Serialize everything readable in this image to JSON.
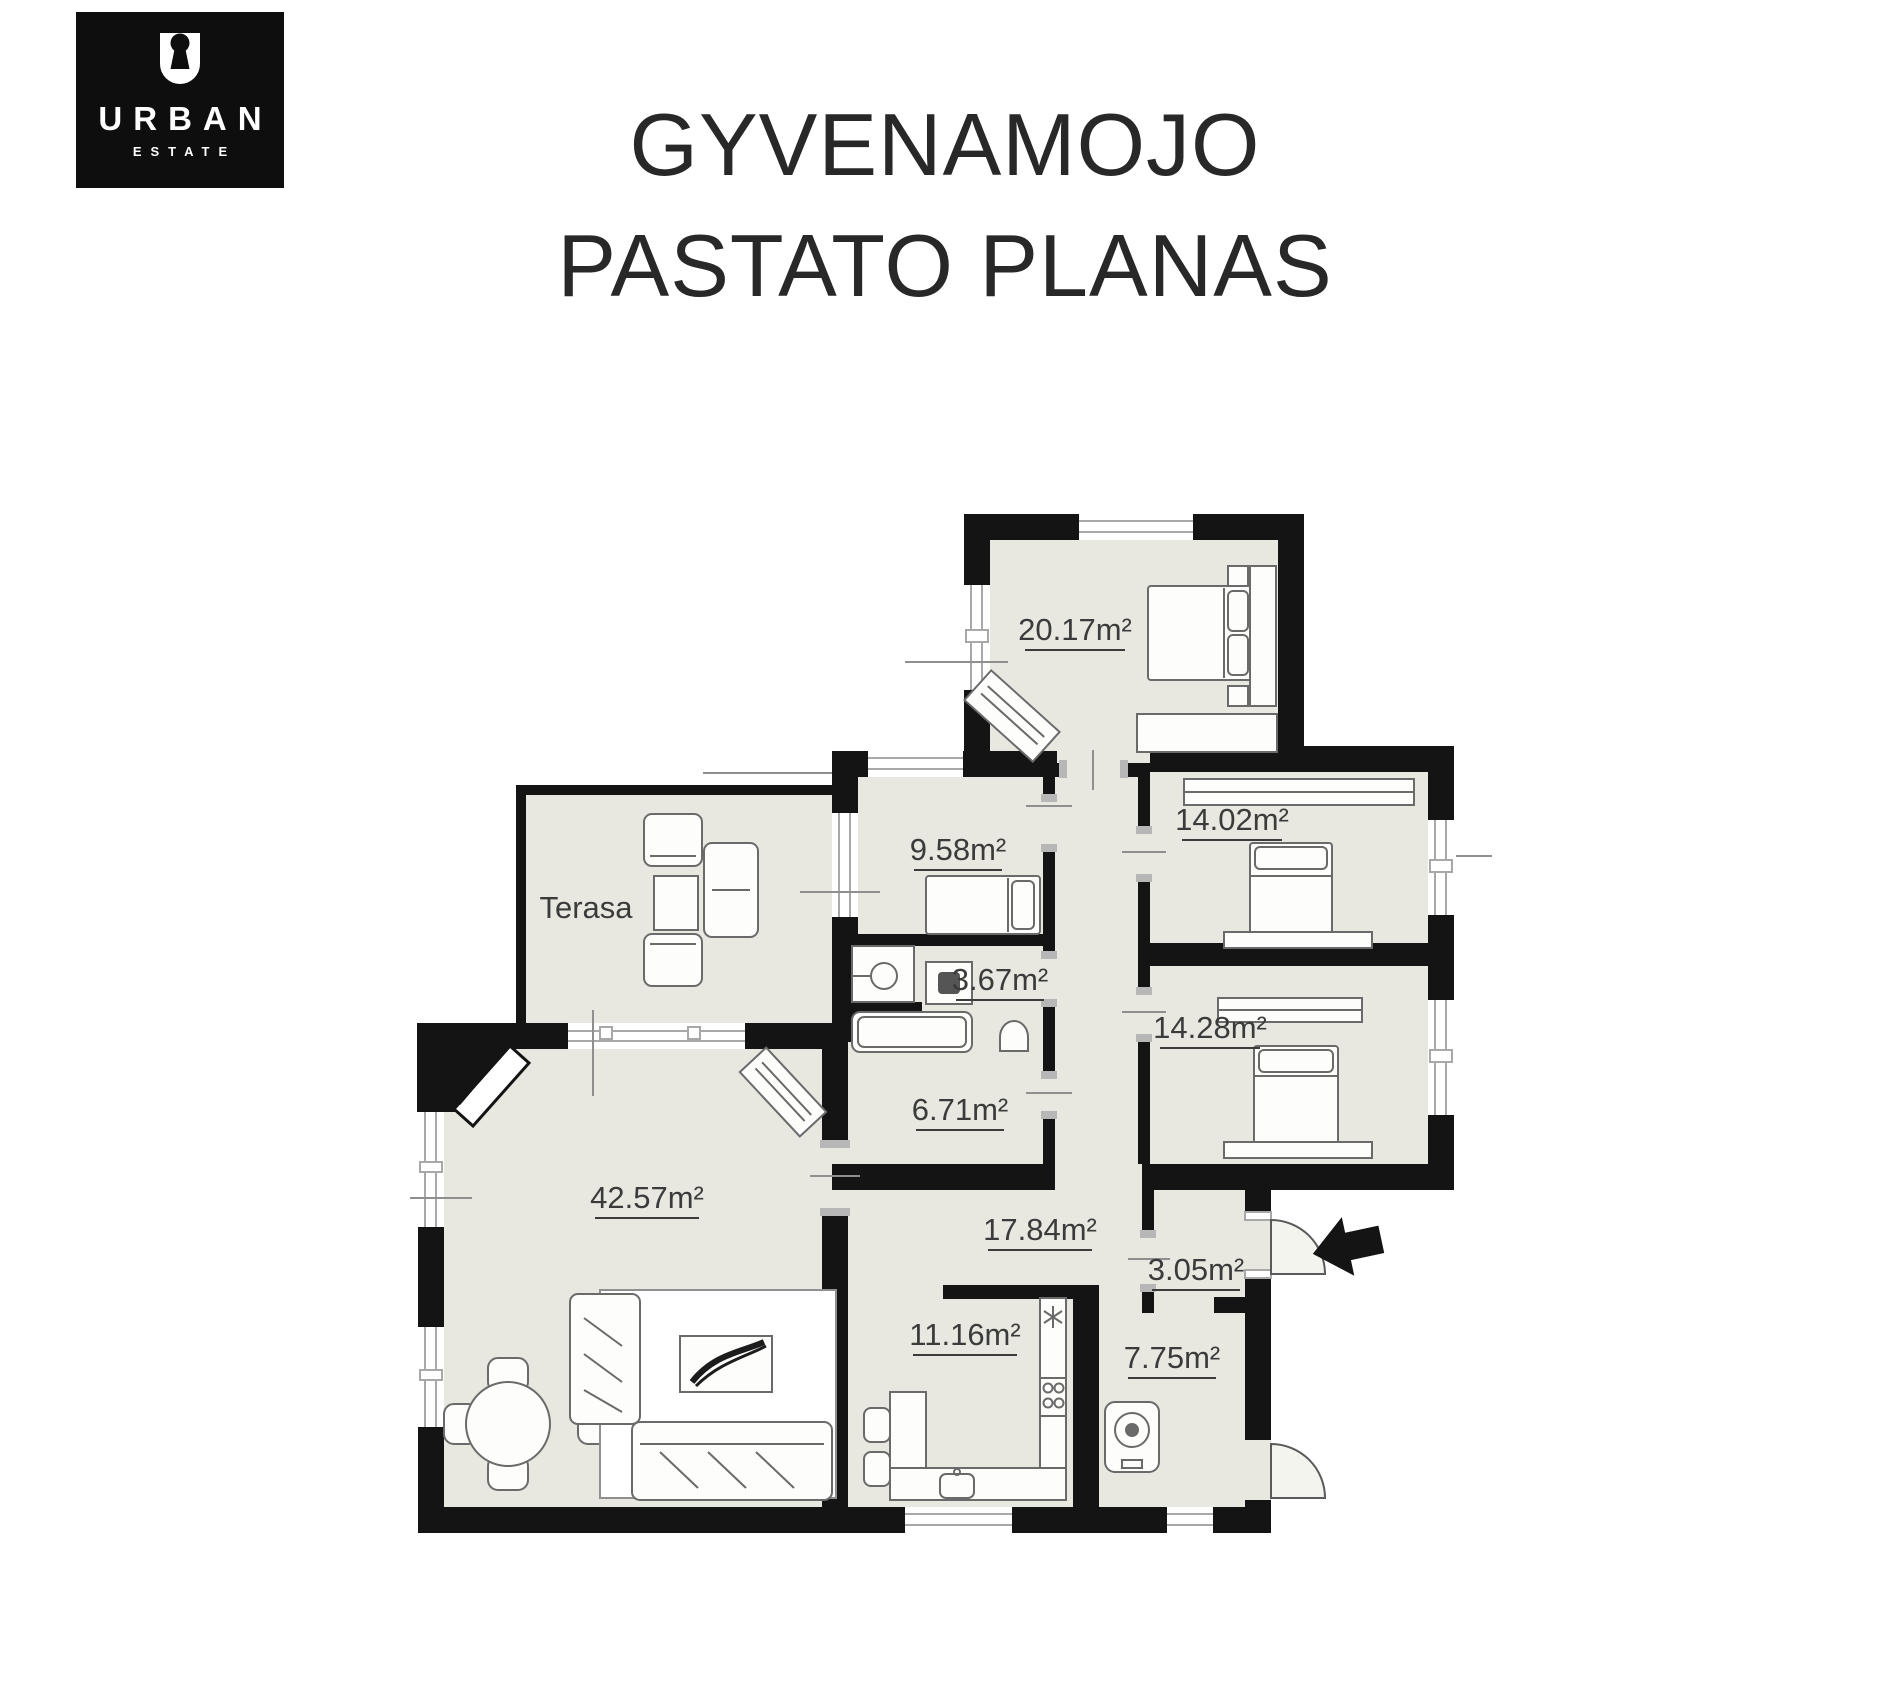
{
  "logo": {
    "brand": "URBAN",
    "subtitle": "ESTATE",
    "icon": "keyhole-icon",
    "bg_color": "#0e0e0e",
    "text_color": "#ffffff"
  },
  "title": {
    "line1": "GYVENAMOJO",
    "line2": "PASTATO PLANAS"
  },
  "floor_plan": {
    "rooms": [
      {
        "id": "bedroom-top",
        "label": "20.17m²"
      },
      {
        "id": "bedroom-small",
        "label": "9.58m²"
      },
      {
        "id": "wc",
        "label": "3.67m²"
      },
      {
        "id": "bedroom-east-1",
        "label": "14.02m²"
      },
      {
        "id": "bedroom-east-2",
        "label": "14.28m²"
      },
      {
        "id": "bathroom",
        "label": "6.71m²"
      },
      {
        "id": "living-room",
        "label": "42.57m²"
      },
      {
        "id": "hallway",
        "label": "17.84m²"
      },
      {
        "id": "kitchen",
        "label": "11.16m²"
      },
      {
        "id": "entry",
        "label": "3.05m²"
      },
      {
        "id": "utility",
        "label": "7.75m²"
      },
      {
        "id": "terrace",
        "label": "Terasa"
      }
    ],
    "icons": {
      "entry_arrow": "entry-arrow-icon",
      "logo_mark": "keyhole-icon"
    },
    "colors": {
      "wall": "#141414",
      "floor": "#e8e8e1",
      "label_text": "#3b3b3b"
    }
  }
}
